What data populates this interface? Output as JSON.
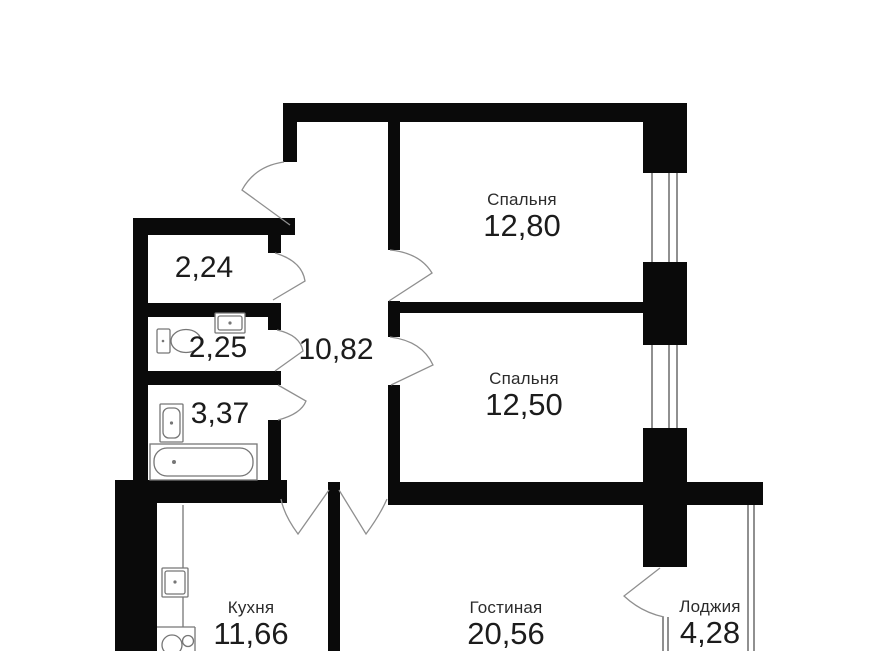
{
  "colors": {
    "wall": "#0a0a0a",
    "thin_line": "#909090",
    "furniture_line": "#767676",
    "text": "#212121",
    "background": "#ffffff"
  },
  "rooms": {
    "bedroom_top": {
      "name": "Спальня",
      "area": "12,80"
    },
    "bedroom_mid": {
      "name": "Спальня",
      "area": "12,50"
    },
    "hallway": {
      "area": "10,82"
    },
    "storage": {
      "area": "2,24"
    },
    "wc": {
      "area": "2,25"
    },
    "bathroom": {
      "area": "3,37"
    },
    "kitchen": {
      "name": "Кухня",
      "area": "11,66"
    },
    "living_room": {
      "name": "Гостиная",
      "area": "20,56"
    },
    "loggia": {
      "name": "Лоджия",
      "area": "4,28"
    }
  }
}
